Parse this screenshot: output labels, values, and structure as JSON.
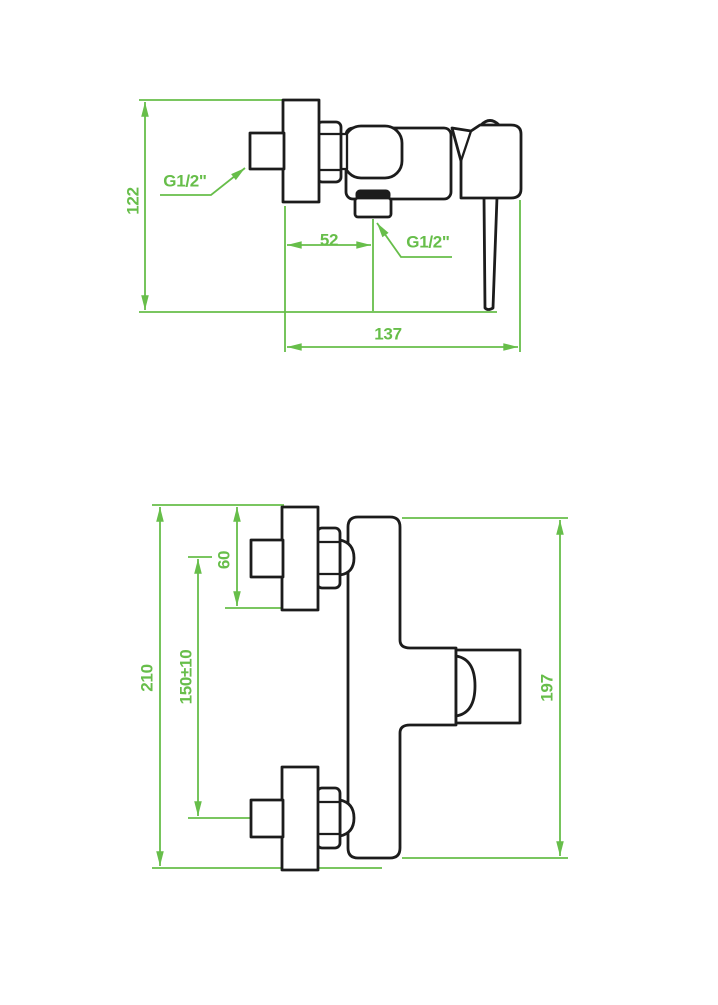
{
  "document": {
    "type": "technical-dimension-drawing",
    "subject": "wall-mounted single-lever shower mixer tap"
  },
  "colors": {
    "dimension_green": "#67be4a",
    "outline_black": "#1c1c1c",
    "background": "#ffffff"
  },
  "views": {
    "side": {
      "name": "side view (top drawing)",
      "dimensions": {
        "overall_height": "122",
        "wall_to_outlet": "52",
        "overall_depth": "137",
        "inlet_thread": "G1/2\"",
        "outlet_thread": "G1/2\""
      }
    },
    "front": {
      "name": "front view (bottom drawing)",
      "dimensions": {
        "overall_height": "210",
        "escutcheon_height": "60",
        "connection_centres": "150±10",
        "body_height": "197"
      }
    }
  }
}
